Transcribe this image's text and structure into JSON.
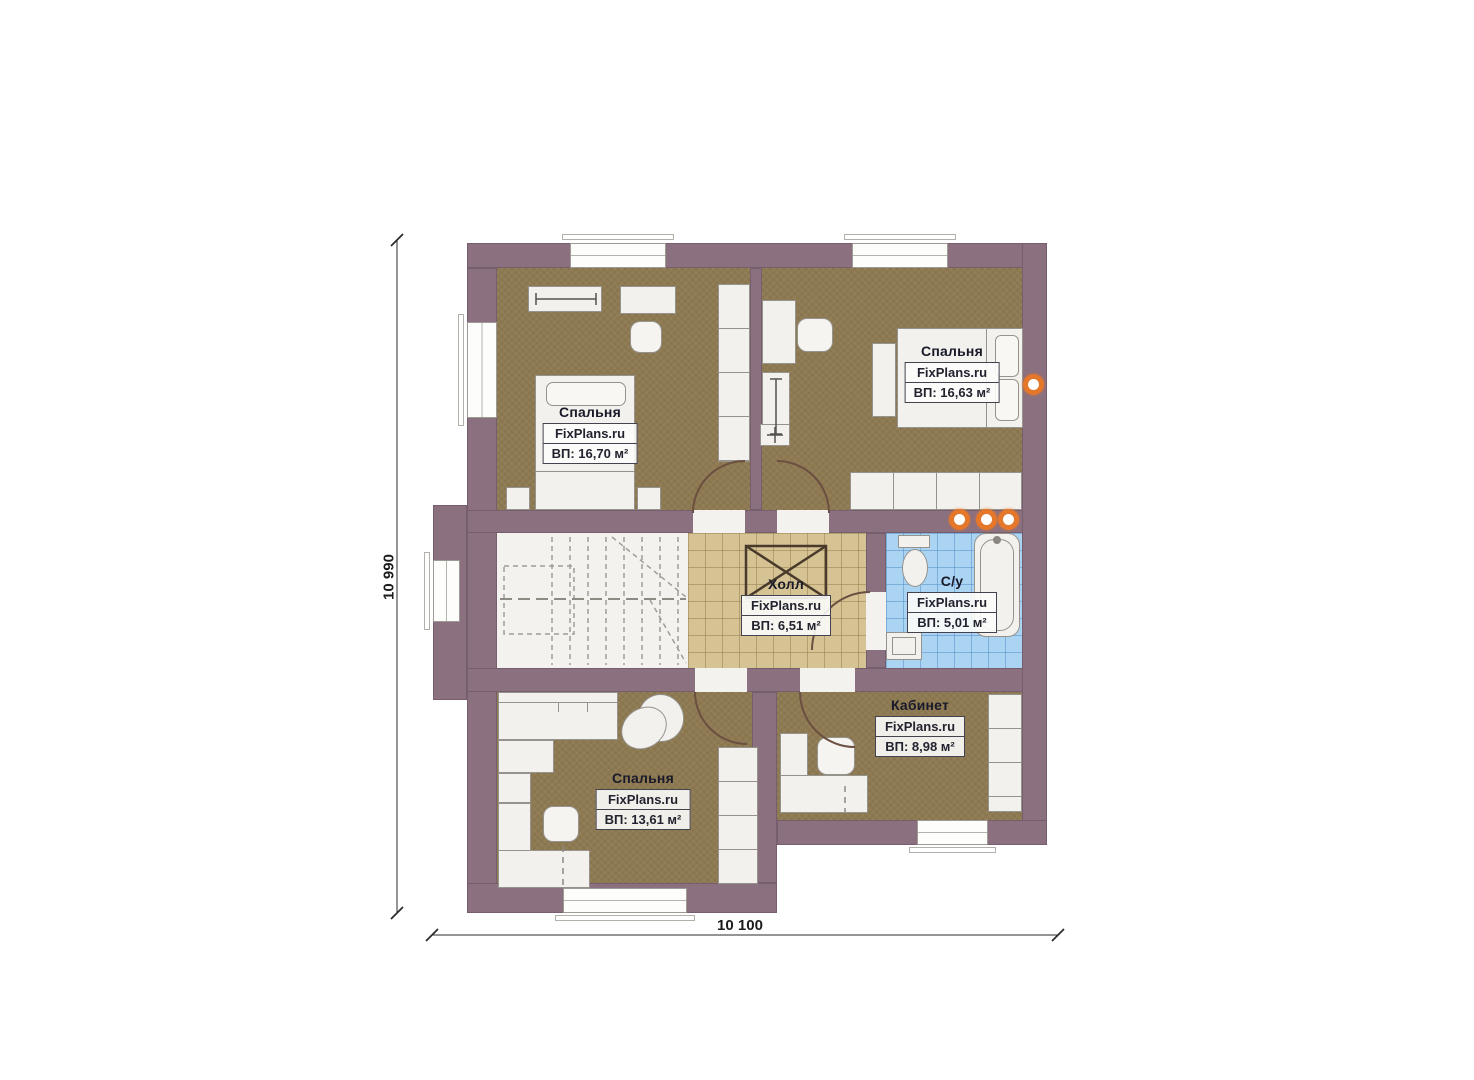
{
  "brand": "FixPlans.ru",
  "dimensions": {
    "height_label": "10 990",
    "width_label": "10 100"
  },
  "rooms": {
    "bedroom_top_left": {
      "name": "Спальня",
      "brand": "FixPlans.ru",
      "area": "ВП: 16,70 м²"
    },
    "bedroom_top_right": {
      "name": "Спальня",
      "brand": "FixPlans.ru",
      "area": "ВП: 16,63 м²"
    },
    "hall": {
      "name": "Холл",
      "brand": "FixPlans.ru",
      "area": "ВП: 6,51 м²"
    },
    "bathroom": {
      "name": "С/у",
      "brand": "FixPlans.ru",
      "area": "ВП: 5,01 м²"
    },
    "bedroom_bottom": {
      "name": "Спальня",
      "brand": "FixPlans.ru",
      "area": "ВП: 13,61 м²"
    },
    "office": {
      "name": "Кабинет",
      "brand": "FixPlans.ru",
      "area": "ВП: 8,98 м²"
    }
  },
  "colors": {
    "wall": "#8b7080",
    "floor_room": "#8e7a52",
    "floor_hall": "#d5c394",
    "floor_bath": "#abd3f2",
    "floor_stairs": "#f3f2ee",
    "accent_orange": "#e4772a"
  }
}
